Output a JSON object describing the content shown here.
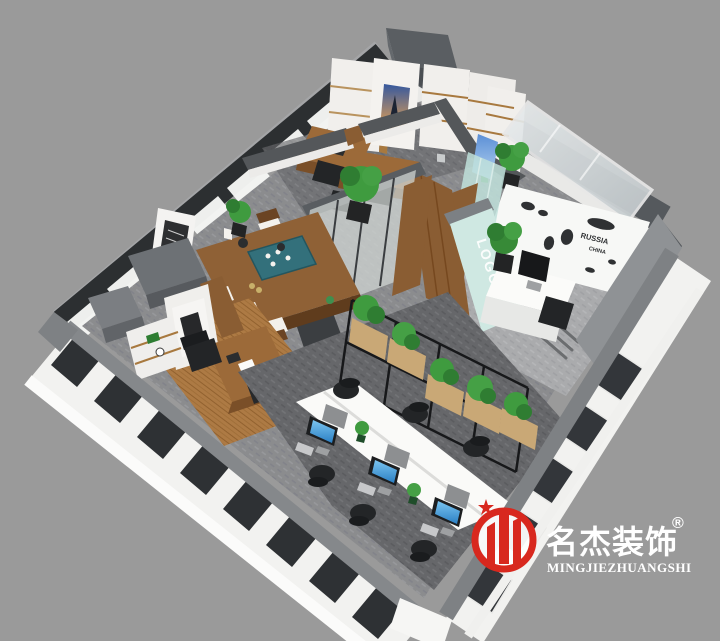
{
  "branding": {
    "logo_cn": "名杰装饰",
    "registered_mark": "®",
    "logo_en": "MINGJIEZHUANGSHI",
    "brand_red": "#d8281e",
    "text_white": "#ffffff"
  },
  "wall_text": {
    "map_label_1": "RUSSIA",
    "map_label_2": "CHINA",
    "logo_wall": "LOGO"
  },
  "palette": {
    "background": "#9a9a9a",
    "wall_dark": "#54585c",
    "wall_light_face": "#8f9295",
    "facade_white": "#f2f2f0",
    "window_dark": "#2e3134",
    "carpet": "#8b8c8e",
    "carpet_dark": "#66676a",
    "wood": "#9c6a39",
    "wood_floor": "#ad7a44",
    "mint_wall": "#cfe8e2",
    "plant_green": "#3f9b3f",
    "screen_blue": "#3d9ce0",
    "desk_white": "#fafaf8"
  }
}
